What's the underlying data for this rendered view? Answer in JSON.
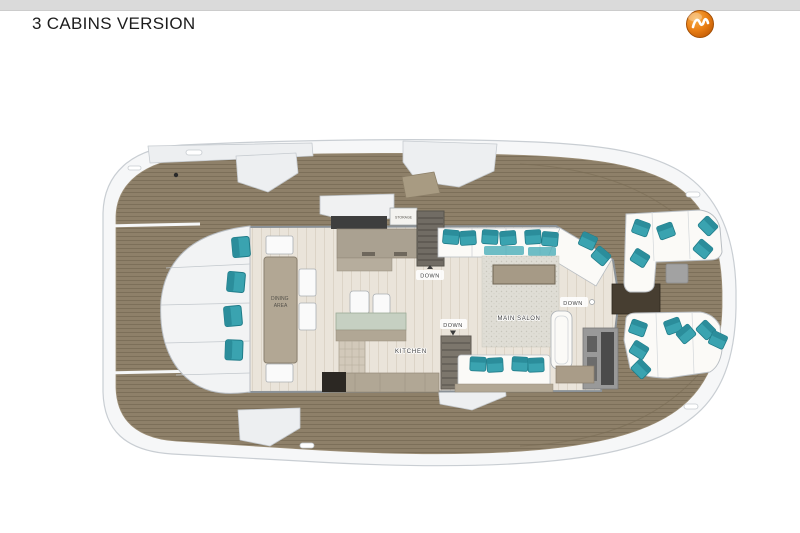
{
  "page": {
    "title": "3 CABINS VERSION"
  },
  "colors": {
    "brand_orange": "#e07816",
    "deck_teak": "#8e8069",
    "interior_floor": "#eae4da",
    "cushion_teal": "#3aa3b0",
    "counter_gray": "#aaa191",
    "top_bar": "#dadada"
  },
  "floorplan": {
    "rooms": {
      "dining_line1": "DINING",
      "dining_line2": "AREA",
      "kitchen": "KITCHEN",
      "main_salon": "MAIN SALON",
      "storage": "STORAGE"
    },
    "stairs": {
      "down_forward": "DOWN",
      "down_galley": "DOWN",
      "down_aft": "DOWN"
    }
  }
}
